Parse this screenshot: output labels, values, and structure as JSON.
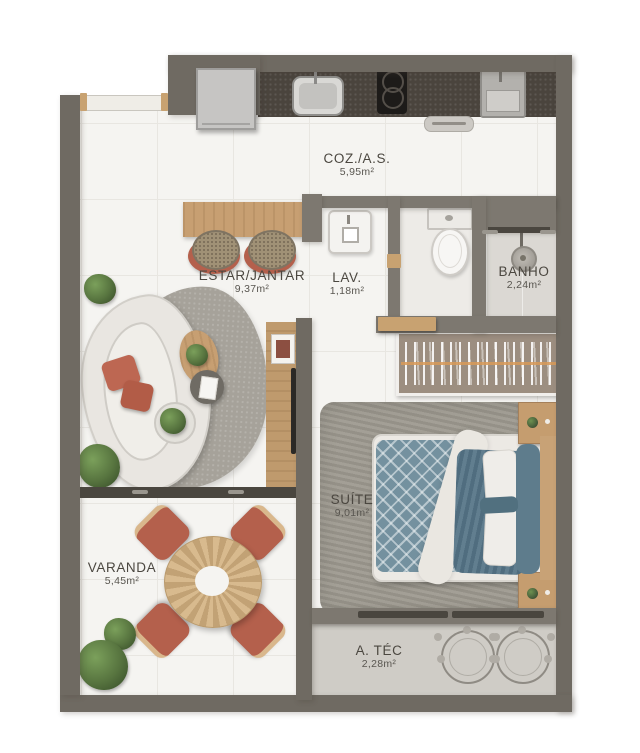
{
  "title": "Apartment floor plan",
  "rooms": [
    {
      "id": "coz",
      "name": "COZ./A.S.",
      "area": "5,95m²"
    },
    {
      "id": "estar",
      "name": "ESTAR/JANTAR",
      "area": "9,37m²"
    },
    {
      "id": "lav",
      "name": "LAV.",
      "area": "1,18m²"
    },
    {
      "id": "banho",
      "name": "BANHO",
      "area": "2,24m²"
    },
    {
      "id": "suite",
      "name": "SUÍTE",
      "area": "9,01m²"
    },
    {
      "id": "varanda",
      "name": "VARANDA",
      "area": "5,45m²"
    },
    {
      "id": "atec",
      "name": "A. TÉC",
      "area": "2,28m²"
    }
  ],
  "colors": {
    "wall": "#6f6a62",
    "wallinner": "#7d7870",
    "floor": "#f5f4f1",
    "tileline": "#e8e6e1",
    "counter": "#4a443d",
    "wood": "#c79f72",
    "woodlight": "#c8a271",
    "terracotta": "#b4604c",
    "sofa": "#e9e6e1",
    "rug": "#a6a29a",
    "suiterug": "#9d998f",
    "duvet": "#74919f",
    "duvetdark": "#557487",
    "plant": "#57743f",
    "banhofloor": "#dbd8d3",
    "atecfloor": "#cfccc6",
    "track": "#4a463f",
    "text": "#4b4740"
  }
}
